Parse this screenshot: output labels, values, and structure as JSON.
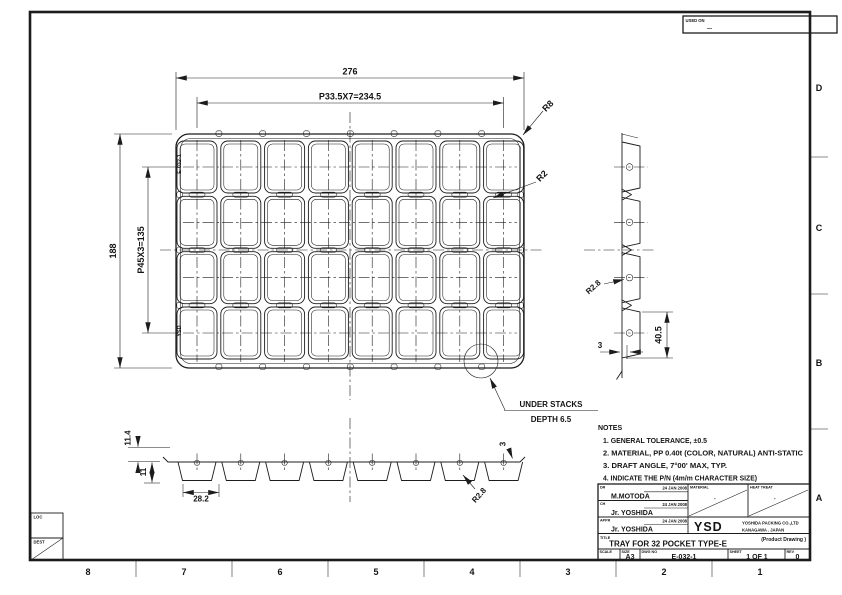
{
  "sheet": {
    "zone_columns": [
      "8",
      "7",
      "6",
      "5",
      "4",
      "3",
      "2",
      "1"
    ],
    "zone_rows": [
      "D",
      "C",
      "B",
      "A"
    ],
    "used_on_label": "USED ON",
    "used_on_value": "—",
    "loc_label": "LOC",
    "dest_label": "DEST"
  },
  "plan_view": {
    "grid": {
      "cols": 8,
      "rows": 4
    },
    "dim_overall_width": "276",
    "dim_pocket_pitch_x": "P33.5X7=234.5",
    "dim_overall_height": "188",
    "dim_pocket_pitch_y": "P45X3=135",
    "radius_outer": "R8",
    "radius_pocket": "R2",
    "tray_marking_part_no": "E-032-1",
    "tray_marking_logo": "YSD",
    "callout_line1": "UNDER STACKS",
    "callout_line2": "DEPTH 6.5"
  },
  "side_view": {
    "radius": "R2.8",
    "dim_flange": "3",
    "dim_height": "40.5"
  },
  "front_view": {
    "dim_stack": "11.4",
    "dim_depth": "11",
    "dim_pocket": "28.2",
    "dim_lip": "3",
    "radius": "R2.8"
  },
  "notes": {
    "title": "NOTES",
    "items": [
      "1. GENERAL TOLERANCE, ±0.5",
      "2. MATERIAL, PP 0.40t (COLOR, NATURAL) ANTI-STATIC",
      "3. DRAFT ANGLE, 7°00' MAX, TYP.",
      "4. INDICATE THE P/N (4m/m CHARACTER SIZE)"
    ]
  },
  "title_block": {
    "rows": [
      {
        "label": "DR",
        "date": "24 JAN 2008",
        "name": "M.MOTODA"
      },
      {
        "label": "CH",
        "date": "24 JAN 2008",
        "name": "Jr. YOSHIDA"
      },
      {
        "label": "APPR",
        "date": "24 JAN 2008",
        "name": "Jr. YOSHIDA"
      }
    ],
    "material_label": "MATERIAL",
    "material_value": "-",
    "heat_treat_label": "HEAT TREAT",
    "heat_treat_value": "-",
    "logo": "YSD",
    "company_line1": "YOSHIDA PACKING CO.,LTD",
    "company_line2": "KANAGAWA . JAPAN",
    "product_note": "(Product Drawing )",
    "title_label": "TITLE",
    "title": "TRAY FOR 32 POCKET TYPE-E",
    "scale_label": "SCALE",
    "size_label": "SIZE",
    "size": "A3",
    "dwg_label": "DWG NO",
    "dwg_no": "E-032-1",
    "sheet_label": "SHEET",
    "sheet": "1 OF 1",
    "rev_label": "REV",
    "rev": "0"
  }
}
